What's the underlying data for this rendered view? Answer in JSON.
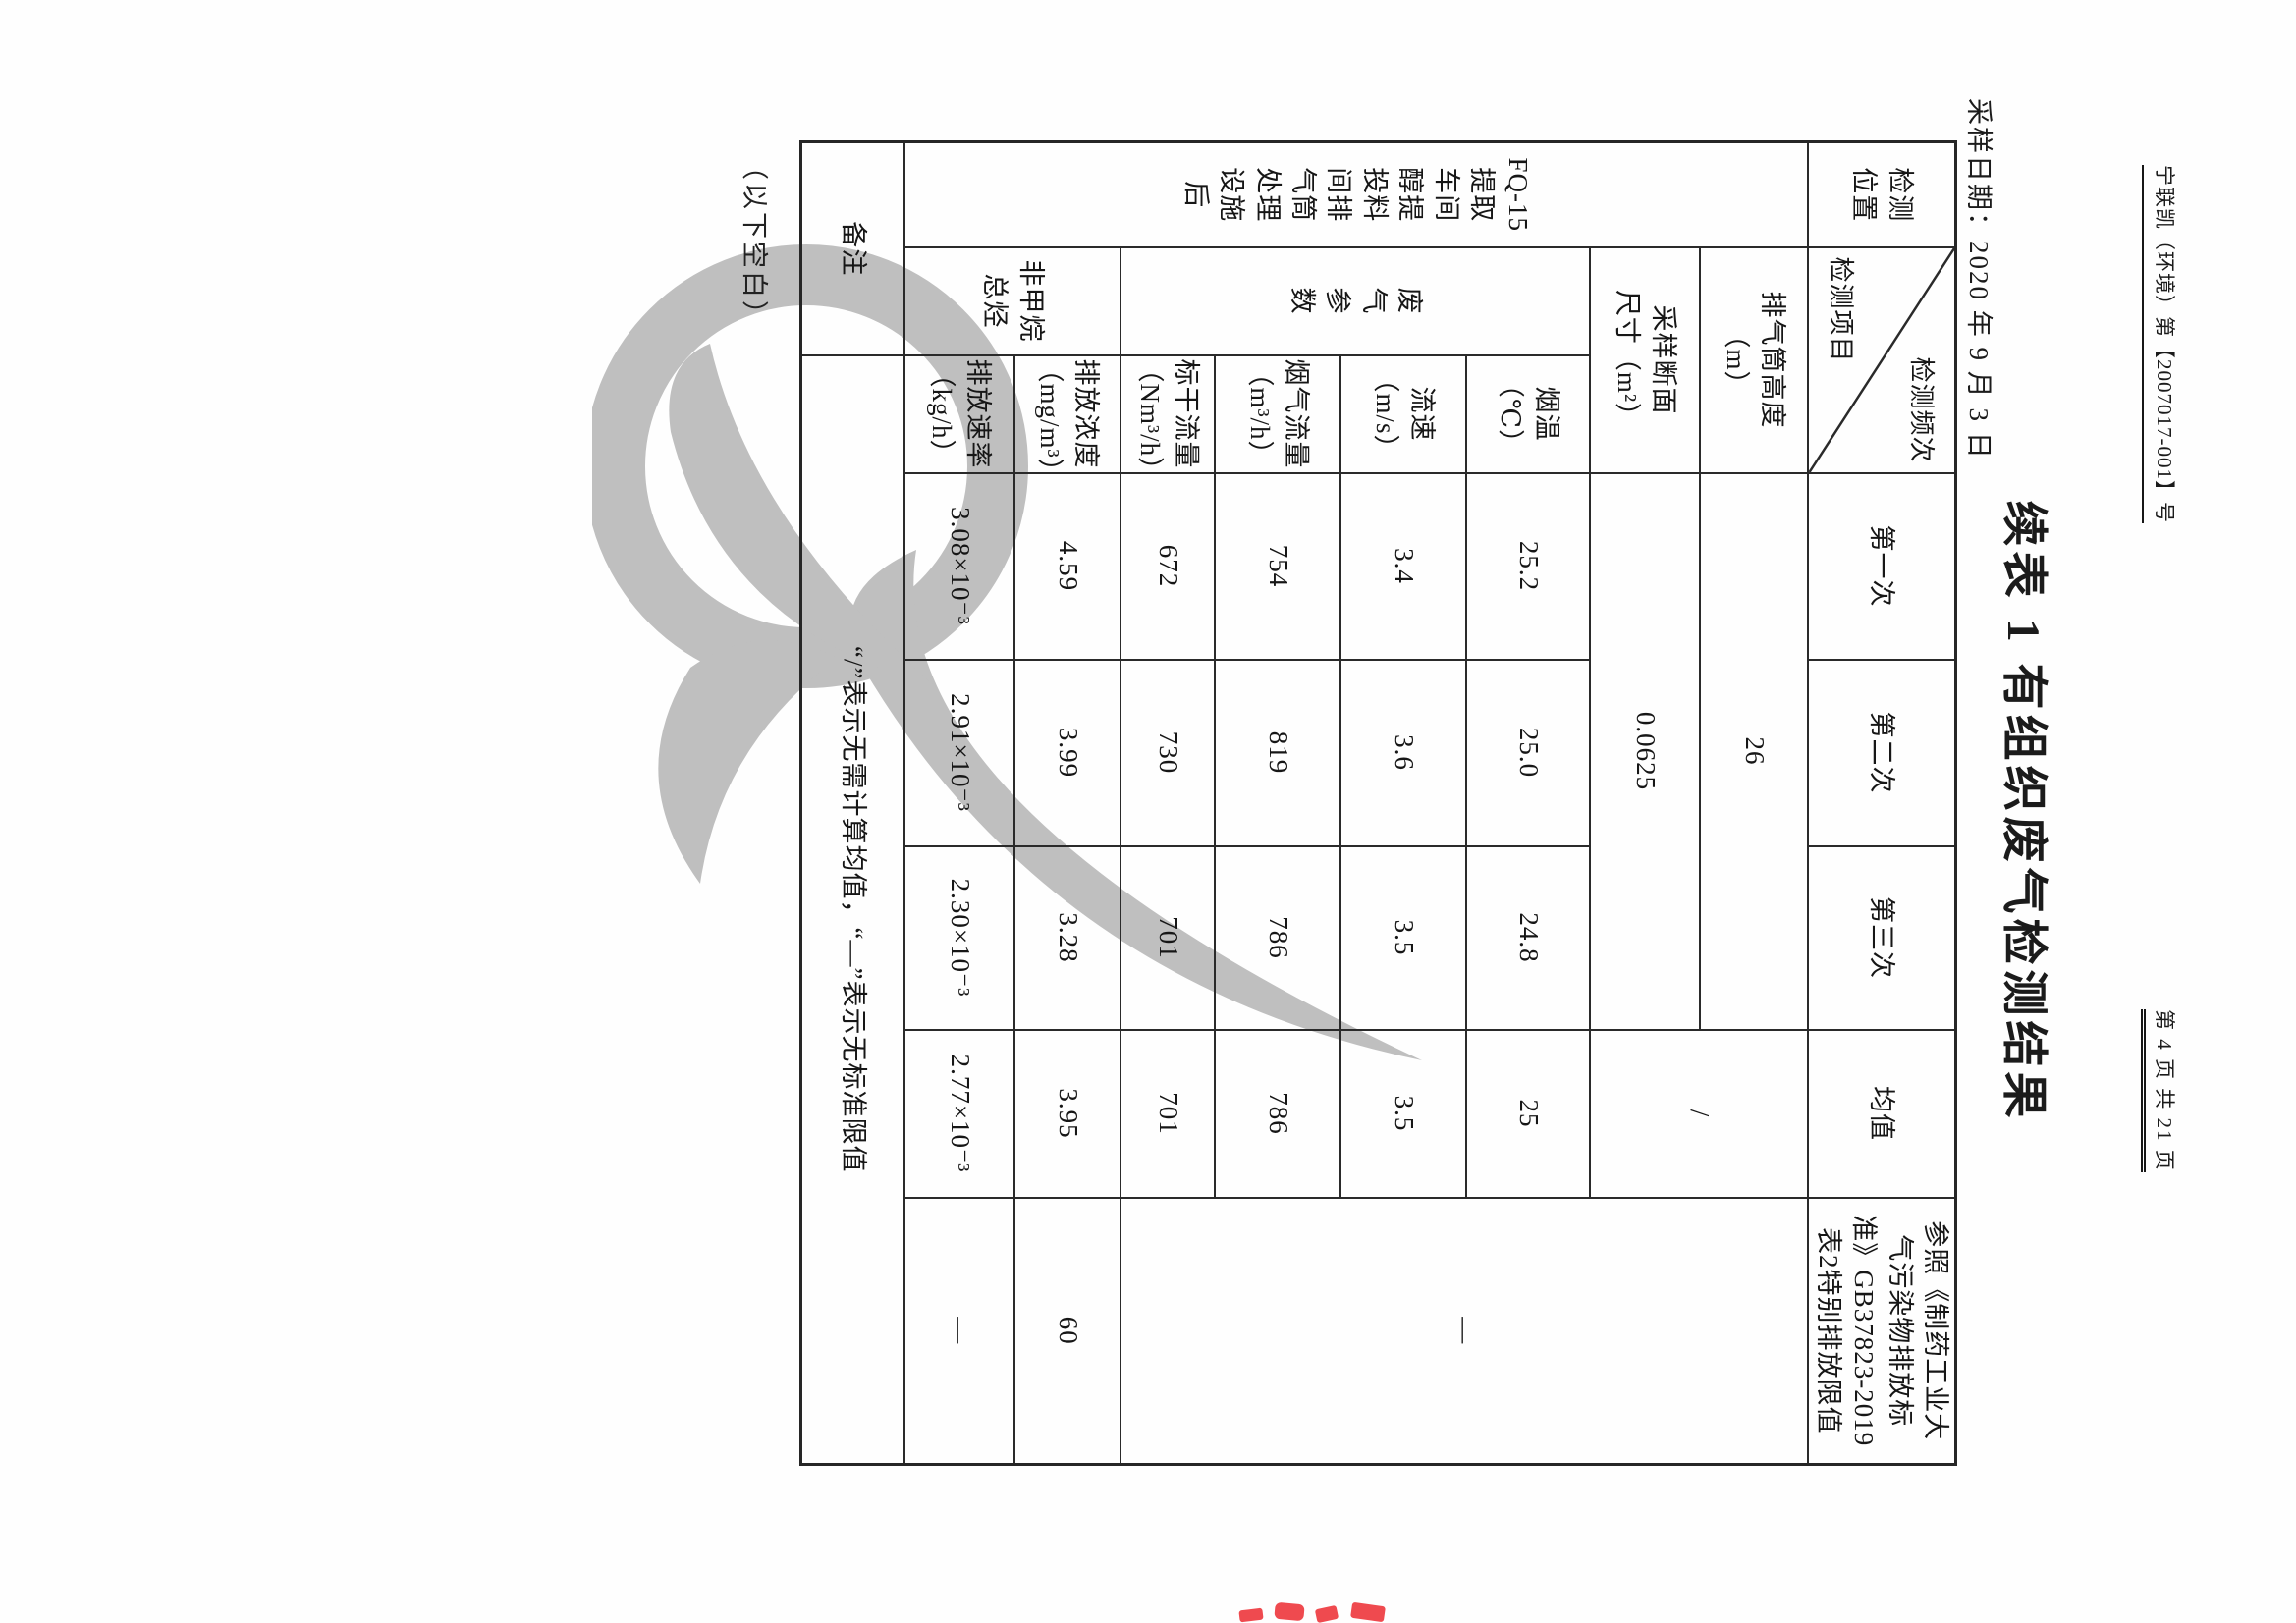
{
  "document": {
    "report_no": "宁联凯（环境）第【2007017-001】号",
    "page_indicator": "第 4 页 共 21 页",
    "title": "续表 1  有组织废气检测结果",
    "sampling_date": "采样日期：2020 年 9 月 3 日",
    "trailing_note": "（以下空白）"
  },
  "table": {
    "location_header": "检测\n位置",
    "corner": {
      "top_right": "检测频次",
      "bottom_left": "检测项目"
    },
    "freq_headers": [
      "第一次",
      "第二次",
      "第三次",
      "均值"
    ],
    "standard_header": "参照《制药工业大\n气污染物排放标\n准》GB37823-2019\n表2特别排放限值",
    "location_value": "FQ-15\n提取\n车间\n醇提\n投料\n间排\n气筒\n处理\n设施\n后",
    "stack_rows": [
      {
        "label": "排气筒高度\n（m）",
        "value": "26"
      },
      {
        "label": "采样断面\n尺寸（m²）",
        "value": "0.0625"
      }
    ],
    "no_mean_symbol": "/",
    "no_standard_symbol": "—",
    "gas_group_label": "废\n气\n参\n数",
    "gas_rows": [
      {
        "label": "烟温\n（℃）",
        "v1": "25.2",
        "v2": "25.0",
        "v3": "24.8",
        "mean": "25"
      },
      {
        "label": "流速\n（m/s）",
        "v1": "3.4",
        "v2": "3.6",
        "v3": "3.5",
        "mean": "3.5"
      },
      {
        "label": "烟气流量\n（m³/h）",
        "v1": "754",
        "v2": "819",
        "v3": "786",
        "mean": "786"
      },
      {
        "label": "标干流量\n（Nm³/h）",
        "v1": "672",
        "v2": "730",
        "v3": "701",
        "mean": "701"
      }
    ],
    "nmhc_group_label": "非甲烷\n总烃",
    "nmhc_rows": [
      {
        "label": "排放浓度\n（mg/m³）",
        "v1": "4.59",
        "v2": "3.99",
        "v3": "3.28",
        "mean": "3.95",
        "standard": "60"
      },
      {
        "label": "排放速率\n（kg/h）",
        "v1": "3.08×10⁻³",
        "v2": "2.91×10⁻³",
        "v3": "2.30×10⁻³",
        "mean": "2.77×10⁻³",
        "standard": "—"
      }
    ],
    "remark_label": "备注",
    "remark_content": "“/”表示无需计算均值，“—”表示无标准限值"
  },
  "colors": {
    "watermark": "#b2b2b2",
    "stamp": "#ef4a4f"
  }
}
